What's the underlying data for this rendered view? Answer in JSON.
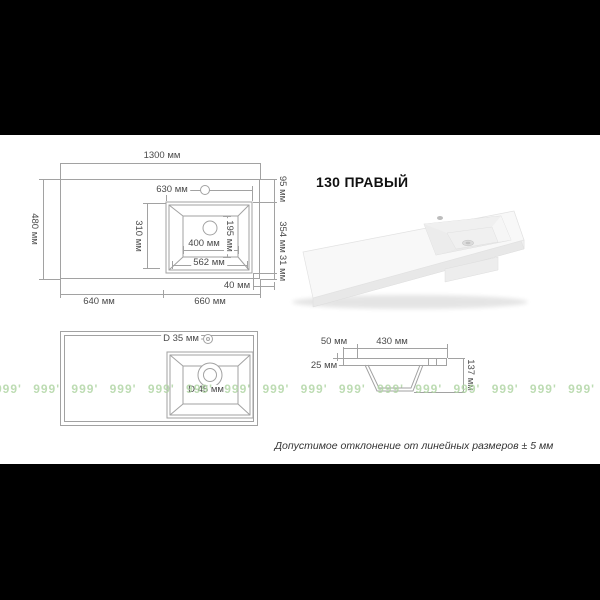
{
  "title": "130 ПРАВЫЙ",
  "note": "Допустимое отклонение от линейных размеров ± 5 мм",
  "watermark": {
    "unit": "999'",
    "count": 22,
    "color": "#b2d6a6"
  },
  "plan_view": {
    "total_width": "1300 мм",
    "total_depth": "480 мм",
    "sink_top_width": "630 мм",
    "sink_left_depth": "310 мм",
    "basin_inner_depth": "195 мм",
    "basin_inner_width": "400 мм",
    "sink_bottom_width": "562 мм",
    "right_top": "95 мм",
    "right_middle": "354 мм",
    "right_bottom": "31 мм",
    "right_gap": "40 мм",
    "bottom_left": "640 мм",
    "bottom_right": "660 мм"
  },
  "holes_view": {
    "faucet_hole": "D 35 мм",
    "drain_hole": "D 45 мм"
  },
  "section_view": {
    "left_offset": "50 мм",
    "basin_width": "430 мм",
    "slab_thickness": "25 мм",
    "total_depth": "137 мм"
  }
}
